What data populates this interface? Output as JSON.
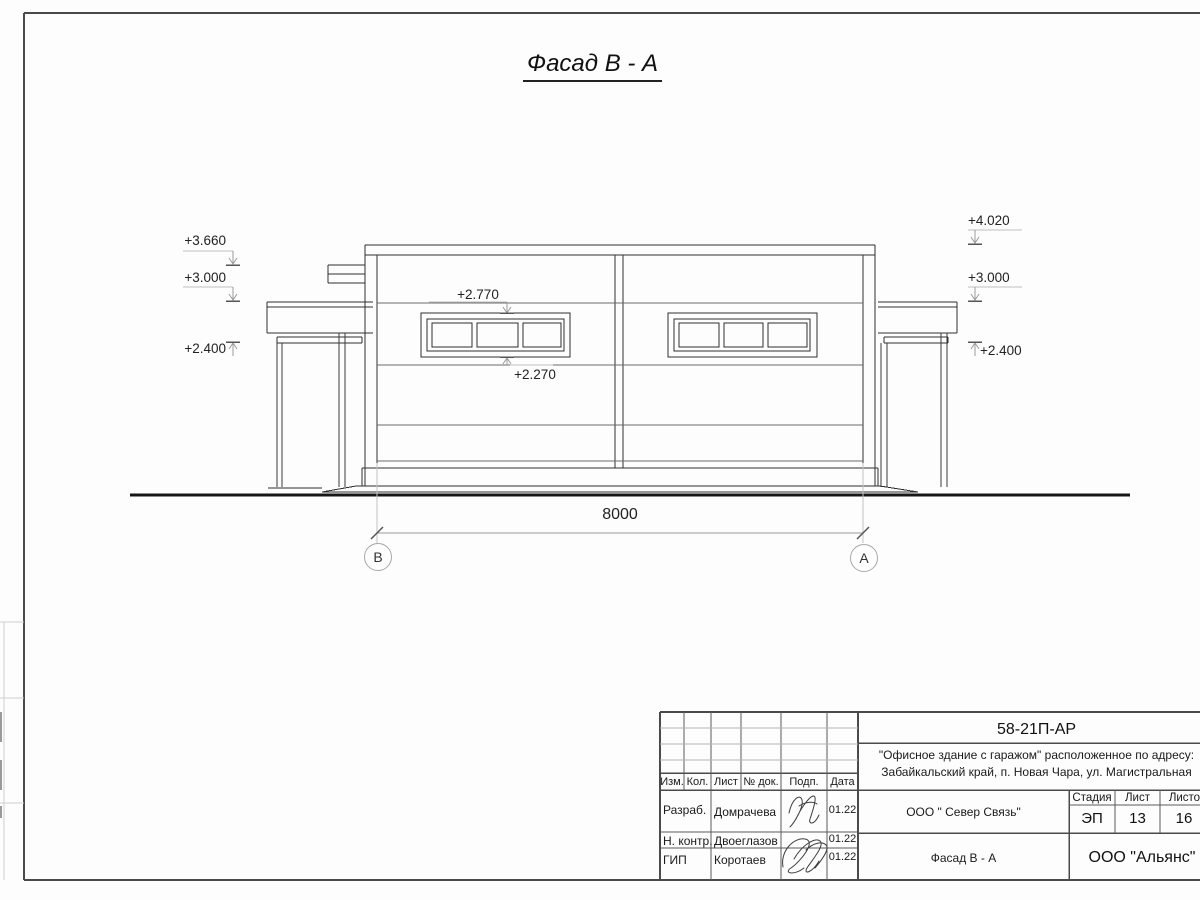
{
  "sheet": {
    "title": "Фасад В - А"
  },
  "levels": {
    "left_top": "+3.660",
    "left_mid": "+3.000",
    "left_low": "+2.400",
    "right_top": "+4.020",
    "right_mid": "+3.000",
    "right_low": "+2.400",
    "window_head": "+2.770",
    "window_sill": "+2.270"
  },
  "dimension": {
    "width": "8000",
    "axis_left": "В",
    "axis_right": "А"
  },
  "title_block": {
    "doc_number": "58-21П-АР",
    "project_address_line1": "\"Офисное здание с гаражом\" расположенное по адресу:",
    "project_address_line2": "Забайкальский край, п. Новая Чара, ул. Магистральная",
    "client": "ООО \" Север Связь\"",
    "drawing_name": "Фасад В - А",
    "company": "ООО \"Альянс\"",
    "stage_label": "Стадия",
    "stage_value": "ЭП",
    "sheet_label": "Лист",
    "sheet_value": "13",
    "sheets_label": "Листов",
    "sheets_value": "16",
    "header_columns": [
      "Изм.",
      "Кол.",
      "Лист",
      "№ док.",
      "Подп.",
      "Дата"
    ],
    "rows": [
      {
        "role": "Разраб.",
        "name": "Домрачева",
        "date": "01.22"
      },
      {
        "role": "Н. контр.",
        "name": "Двоеглазов",
        "date": "01.22"
      },
      {
        "role": "ГИП",
        "name": "Коротаев",
        "date": "01.22"
      }
    ]
  }
}
